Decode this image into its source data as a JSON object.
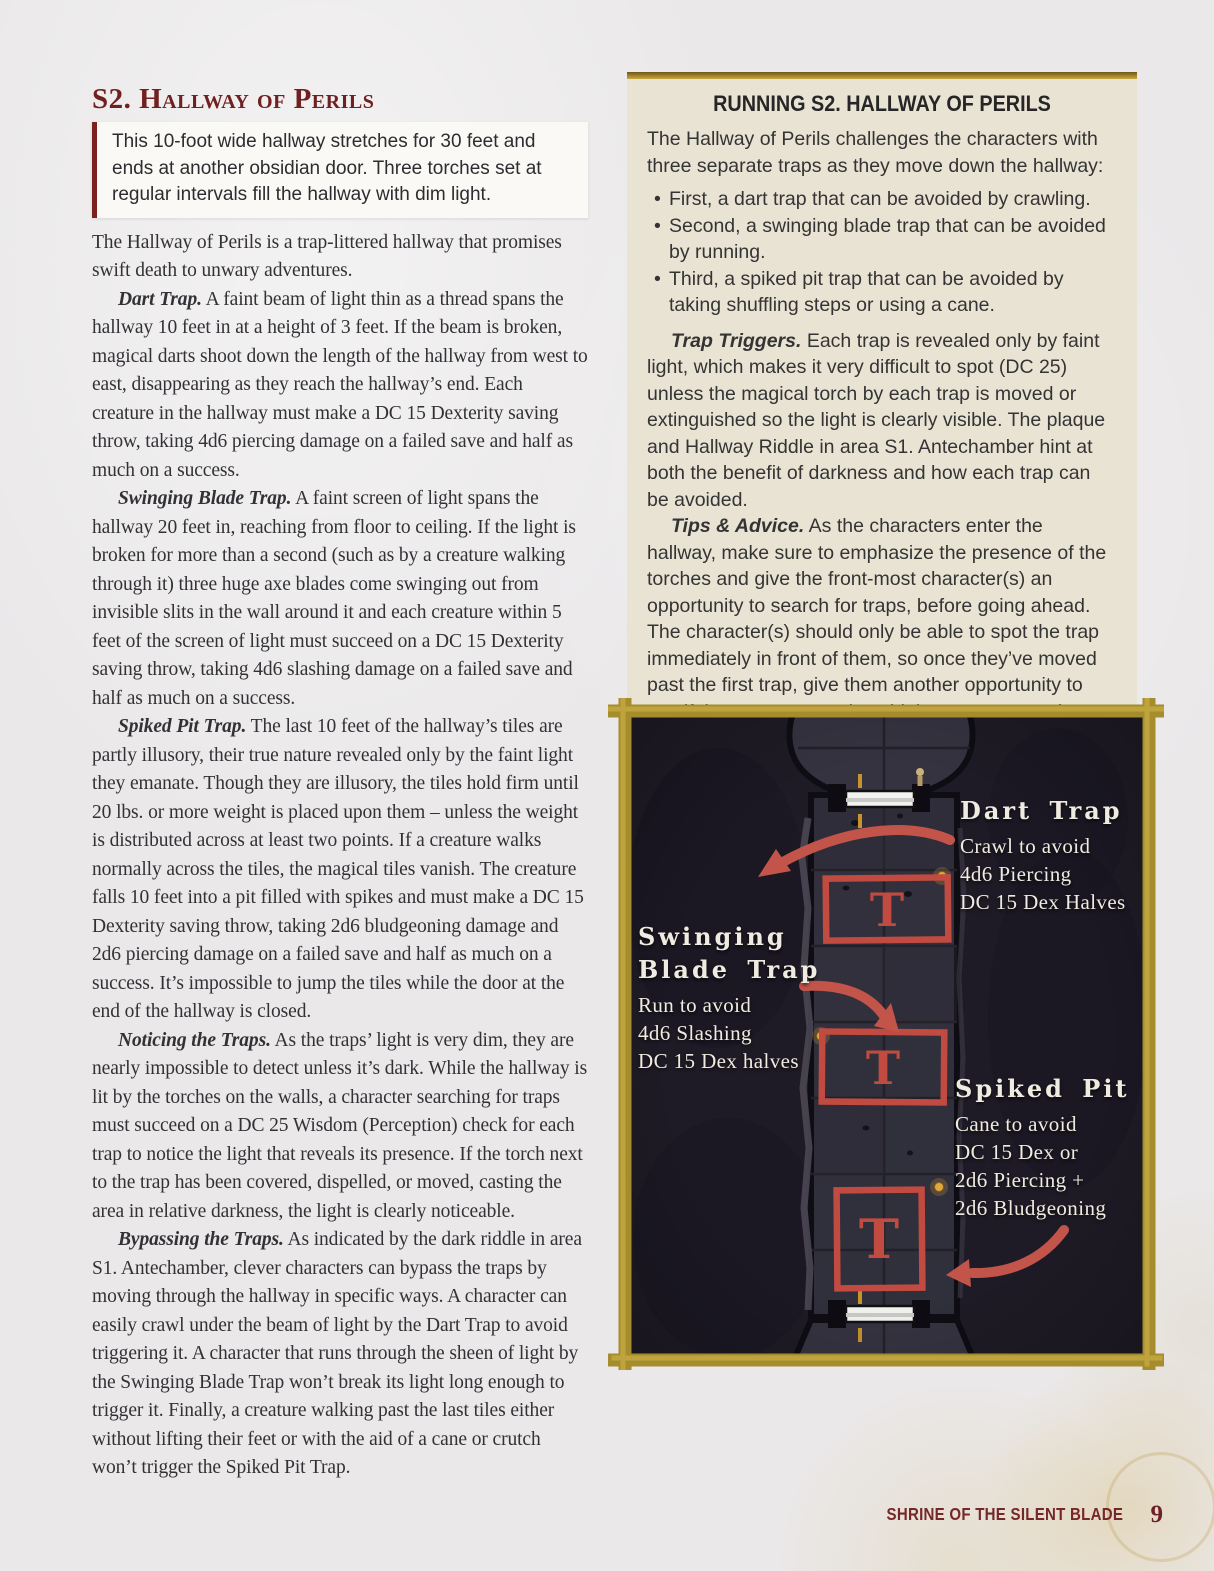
{
  "colors": {
    "accent_maroon": "#712022",
    "parchment": "#eae8e9",
    "readaloud_bg": "#fbf9f5",
    "sidebar_bg": "#e9e3d4",
    "frame_gold": "#ab9030",
    "trap_red": "#c14b41",
    "map_floor": "#343240",
    "map_rock": "#1f1b26",
    "map_label_text": "#f0ebe0"
  },
  "left_column": {
    "heading": "S2. Hallway of Perils",
    "read_aloud": "This 10-foot wide hallway stretches for 30 feet and ends at another obsidian door. Three torches set at regular intervals fill the hallway with dim light.",
    "intro": "The Hallway of Perils is a trap-littered hallway that promises swift death to unwary adventures.",
    "paragraphs": [
      {
        "lead": "Dart Trap.",
        "text": "A faint beam of light thin as a thread spans the hallway 10 feet in at a height of 3 feet. If the beam is broken, magical darts shoot down the length of the hallway from west to east, disappearing as they reach the hallway’s end. Each creature in the hallway must make a DC 15 Dexterity saving throw, taking 4d6 piercing damage on a failed save and half as much on a success."
      },
      {
        "lead": "Swinging Blade Trap.",
        "text": "A faint screen of light spans the hallway 20 feet in, reaching from floor to ceiling. If the light is broken for more than a second (such as by a creature walking through it) three huge axe blades come swinging out from invisible slits in the wall around it and each creature within 5 feet of the screen of light must succeed on a DC 15 Dexterity saving throw, taking 4d6 slashing damage on a failed save and half as much on a success."
      },
      {
        "lead": "Spiked Pit Trap.",
        "text": "The last 10 feet of the hallway’s tiles are partly illusory, their true nature revealed only by the faint light they emanate. Though they are illusory, the tiles hold firm until 20 lbs. or more weight is placed upon them – unless the weight is distributed across at least two points. If a creature walks normally across the tiles, the magical tiles vanish. The creature falls 10 feet into a pit filled with spikes and must make a DC 15 Dexterity saving throw, taking 2d6 bludgeoning damage and 2d6 piercing damage on a failed save and half as much on a success. It’s impossible to jump the tiles while the door at the end of the hallway is closed."
      },
      {
        "lead": "Noticing the Traps.",
        "text": "As the traps’ light is very dim, they are nearly impossible to detect unless it’s dark. While the hallway is lit by the torches on the walls, a character searching for traps must succeed on a DC 25 Wisdom (Perception) check for each trap to notice the light that reveals its presence. If the torch next to the trap has been covered, dispelled, or moved, casting the area in relative darkness, the light is clearly noticeable."
      },
      {
        "lead": "Bypassing the Traps.",
        "text": "As indicated by the dark riddle in area S1. Antechamber, clever characters can bypass the traps by moving through the hallway in specific ways. A character can easily crawl under the beam of light by the Dart Trap to avoid triggering it. A character that runs through the sheen of light by the Swinging Blade Trap won’t break its light long enough to trigger it. Finally, a creature walking past the last tiles either without lifting their feet or with the aid of a cane or crutch won’t trigger the Spiked Pit Trap."
      }
    ]
  },
  "sidebar": {
    "title": "RUNNING S2. HALLWAY OF PERILS",
    "intro": "The Hallway of Perils challenges the characters with three separate traps as they move down the hallway:",
    "bullets": [
      "First, a dart trap that can be avoided by crawling.",
      "Second, a swinging blade trap that can be avoided by running.",
      "Third, a spiked pit trap that can be avoided by taking shuffling steps or using a cane."
    ],
    "paragraphs": [
      {
        "lead": "Trap Triggers.",
        "text": "Each trap is revealed only by faint light, which makes it very difficult to spot (DC 25) unless the magical torch by each trap is moved or extinguished so the light is clearly visible. The plaque and Hallway Riddle in area S1. Antechamber hint at both the benefit of darkness and how each trap can be avoided."
      },
      {
        "lead": "Tips & Advice.",
        "text": "As the characters enter the hallway, make sure to emphasize the presence of the torches and give the front-most character(s) an opportunity to search for traps, before going ahead. The character(s) should only be able to spot the trap immediately in front of them, so once they’ve moved past the first trap, give them another opportunity to see if they can spot and avoid the next trap, and so on."
      }
    ]
  },
  "map": {
    "traps": [
      {
        "title": "Dart Trap",
        "lines": [
          "Crawl to avoid",
          "4d6 Piercing",
          "DC 15 Dex Halves"
        ],
        "marker": "T"
      },
      {
        "title": "Swinging Blade Trap",
        "lines": [
          "Run to avoid",
          "4d6 Slashing",
          "DC 15 Dex halves"
        ],
        "marker": "T"
      },
      {
        "title": "Spiked Pit",
        "lines": [
          "Cane to avoid",
          "DC 15 Dex or",
          "2d6 Piercing +",
          "2d6 Bludgeoning"
        ],
        "marker": "T"
      }
    ]
  },
  "footer": {
    "book_title": "SHRINE OF THE SILENT BLADE",
    "page_number": "9"
  }
}
